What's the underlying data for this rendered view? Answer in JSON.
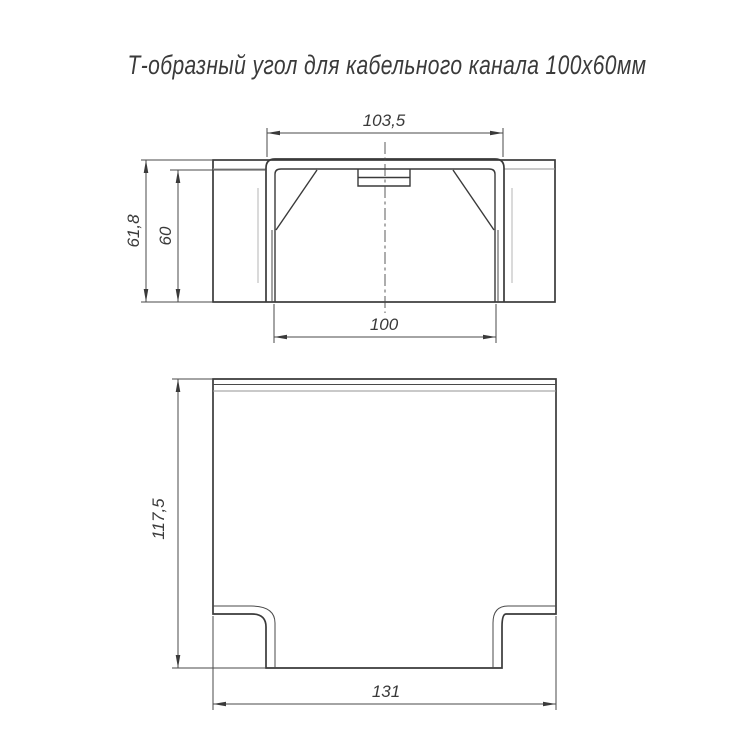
{
  "title": "Т-образный угол для кабельного канала 100х60мм",
  "views": {
    "front": {
      "label": "front-section-view",
      "dims": {
        "outer_width": "103,5",
        "inner_width": "100",
        "outer_height": "61,8",
        "inner_height": "60"
      }
    },
    "plan": {
      "label": "plan-view",
      "dims": {
        "height": "117,5",
        "width": "131"
      }
    }
  },
  "colors": {
    "line": "#3a3a3a",
    "line_gray": "#939393",
    "background": "#ffffff"
  }
}
